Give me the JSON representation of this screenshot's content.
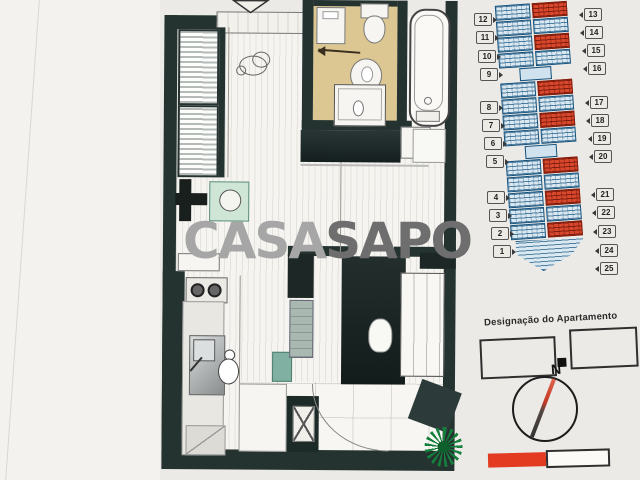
{
  "watermark": {
    "casa": "CASA",
    "sapo": "SAPO"
  },
  "legend": {
    "title": "Designação do Apartamento"
  },
  "compass": {
    "north_label": "N"
  },
  "site_plan": {
    "left_badges": [
      "12",
      "11",
      "10",
      "9",
      "8",
      "7",
      "6",
      "5",
      "4",
      "3",
      "2",
      "1"
    ],
    "right_badges": [
      "13",
      "14",
      "15",
      "16",
      "17",
      "18",
      "19",
      "20",
      "21",
      "22",
      "23",
      "24",
      "25"
    ],
    "highlighted_units": [
      "13",
      "15",
      "17",
      "19",
      "21",
      "23",
      "25"
    ],
    "groups": [
      {
        "rows": [
          {
            "left": "12",
            "right": "13"
          },
          {
            "left": "11",
            "right": "14"
          },
          {
            "left": "10",
            "right": "15"
          },
          {
            "left": "9",
            "right": "16"
          }
        ]
      },
      {
        "rows": [
          {
            "left": "8",
            "right": "17"
          },
          {
            "left": "7",
            "right": "18"
          },
          {
            "left": "6",
            "right": "19"
          },
          {
            "left": "5",
            "right": "20"
          }
        ]
      },
      {
        "rows": [
          {
            "left": "4",
            "right": "21"
          },
          {
            "left": "3",
            "right": "22"
          },
          {
            "left": "2",
            "right": "23"
          },
          {
            "left": "1",
            "right": "24"
          },
          {
            "left": "",
            "right": "25"
          }
        ]
      }
    ]
  },
  "colors": {
    "accent_red": "#e23b22",
    "plan_blue": "#15517c",
    "wall_dark": "#243230",
    "bathroom_floor": "#dcc793",
    "watermark_light": "#a6a6a6",
    "watermark_dark": "#6e6e6e"
  }
}
